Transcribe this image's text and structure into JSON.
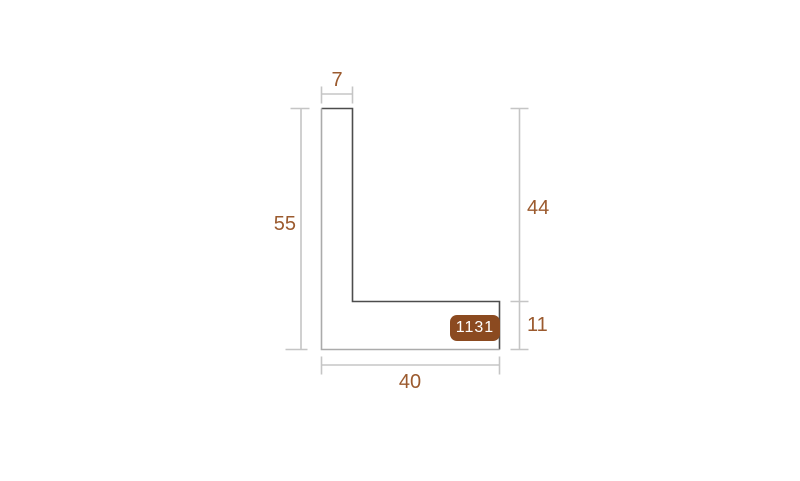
{
  "diagram": {
    "type": "profile-cross-section",
    "profile_id": "1131",
    "dimensions": {
      "top_width": "7",
      "left_height": "55",
      "right_upper_height": "44",
      "right_lower_height": "11",
      "bottom_width": "40"
    },
    "colors": {
      "background": "#ffffff",
      "outline_dark": "#4d4d4d",
      "outline_light": "#ababab",
      "dimension_line": "#c5c5c5",
      "dimension_text": "#9b5a2e",
      "badge_background": "#8b4a20",
      "badge_text": "#ffffff"
    }
  }
}
